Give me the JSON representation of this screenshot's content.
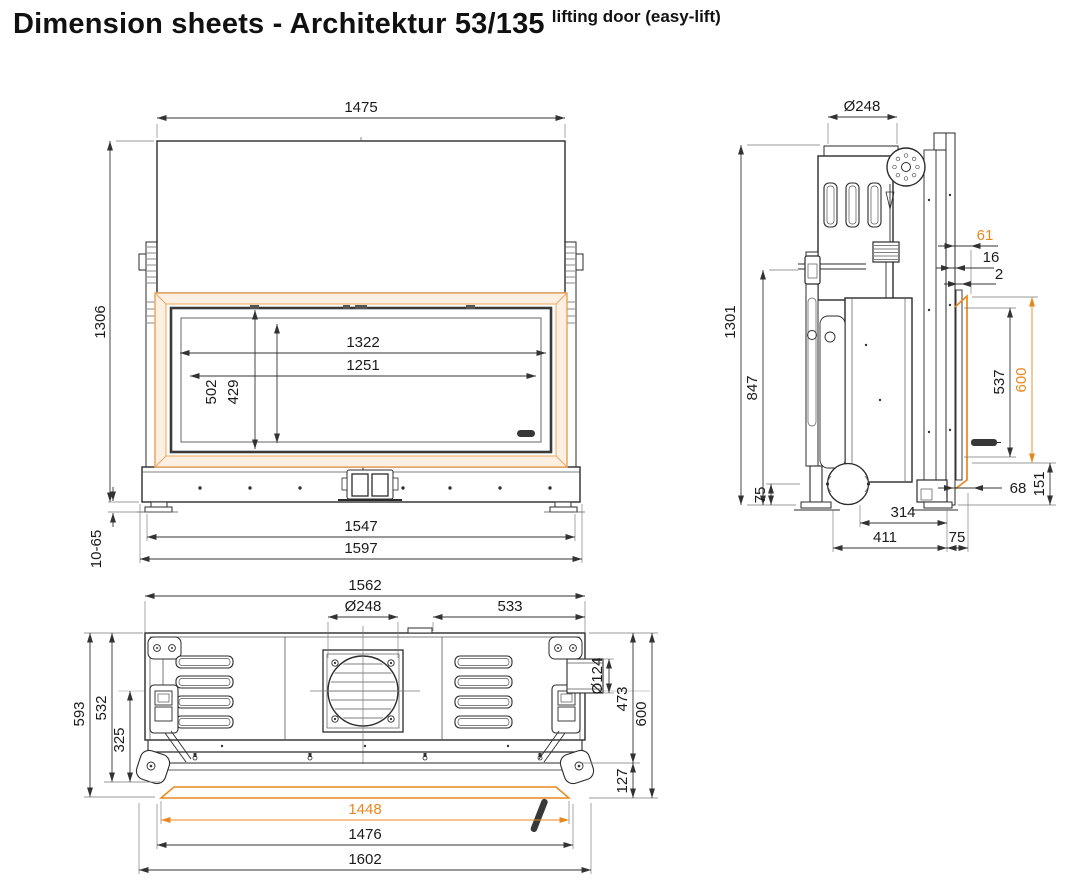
{
  "title": {
    "main": "Dimension sheets - Architektur 53/135",
    "superscript": "lifting door (easy-lift)"
  },
  "colors": {
    "accent_orange": "#e8871d",
    "frame_stroke": "#eda65f",
    "frame_fill": "#fdf0e2",
    "drawing_line": "#2b2b2b",
    "dimension_text": "#1a1a1a"
  },
  "front_view": {
    "dims": {
      "overall_width": "1475",
      "overall_height": "1306",
      "glass_width": "1322",
      "glass_inner_width": "1251",
      "door_height": "502",
      "glass_height": "429",
      "base_width": "1547",
      "base_outer_width": "1597",
      "foot_adjustment": "10-65"
    }
  },
  "side_view": {
    "dims": {
      "flue_diameter": "Ø248",
      "overall_height": "1301",
      "body_height": "847",
      "frame_offset": "61",
      "panel_gap": "16",
      "glass_gap": "2",
      "glass_height": "537",
      "frame_height": "600",
      "duct_center_height": "75",
      "frame_depth": "68",
      "plinth_height": "151",
      "duct_depth": "314",
      "foot_depth": "411",
      "rear_gap": "75"
    }
  },
  "plan_view": {
    "dims": {
      "body_width": "1562",
      "flue_diameter": "Ø248",
      "flue_offset": "533",
      "overall_depth": "593",
      "body_depth": "532",
      "half_depth": "325",
      "air_duct_diameter": "Ø124",
      "front_depth": "473",
      "frame_depth": "600",
      "front_offset": "127",
      "glass_width": "1448",
      "frame_width": "1476",
      "overall_width": "1602"
    }
  }
}
